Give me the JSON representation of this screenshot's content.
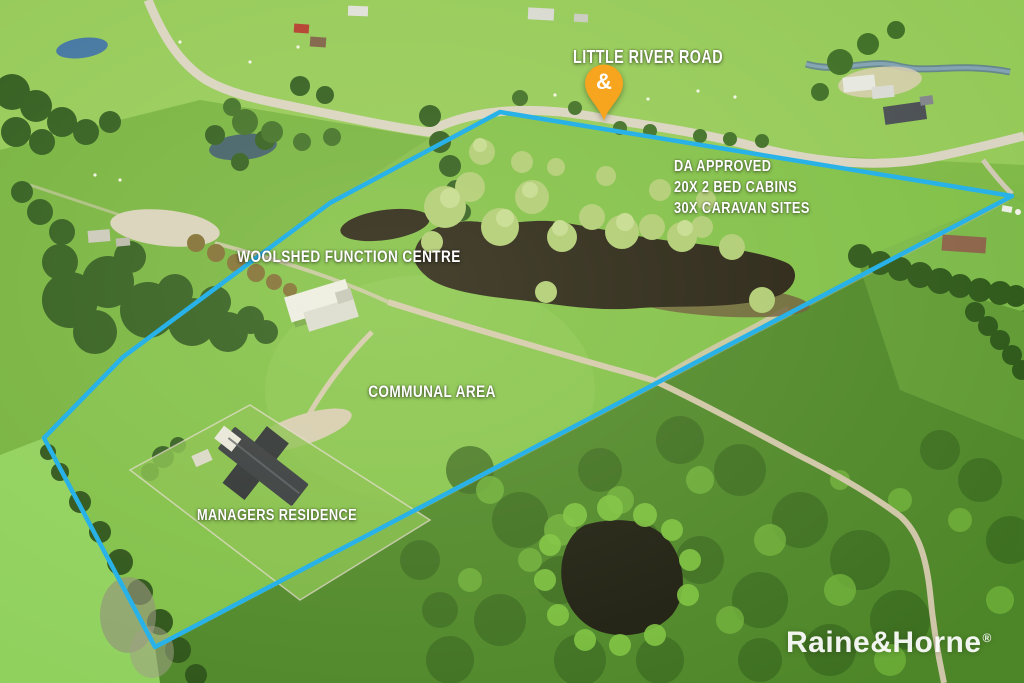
{
  "annotations": {
    "road_label": "LITTLE RIVER ROAD",
    "da_lines": [
      "DA APPROVED",
      "20X 2 BED CABINS",
      "30X CARAVAN SITES"
    ],
    "woolshed_label": "WOOLSHED FUNCTION CENTRE",
    "communal_label": "COMMUNAL AREA",
    "managers_label": "MANAGERS RESIDENCE"
  },
  "pin": {
    "symbol": "&",
    "color": "#F7A41F"
  },
  "boundary": {
    "color": "#29B2E8"
  },
  "watermark": {
    "text": "Raine&Horne",
    "reg": "®"
  }
}
